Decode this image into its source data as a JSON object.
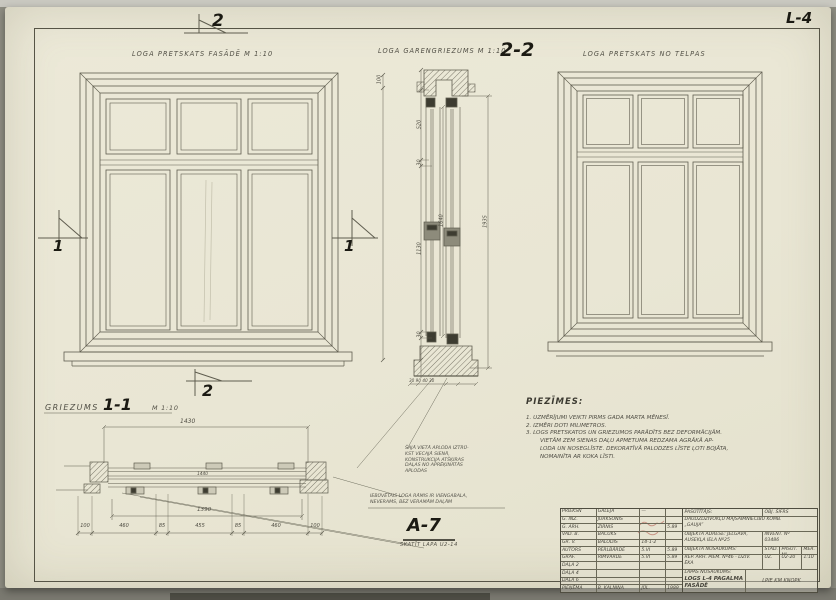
{
  "sheet": {
    "number": "L-4",
    "marks": {
      "top": "2",
      "bottom": "2",
      "left": "1",
      "right": "1"
    }
  },
  "headings": {
    "facade": "LOGA PRETSKATS FASĀDĒ M 1:10",
    "section_title": "LOGA GARENGRIEZUMS M 1:10",
    "section_mark": "2-2",
    "interior": "LOGA PRETSKATS NO TELPAS"
  },
  "vsection": {
    "d100": "100",
    "d520": "520",
    "d30a": "30",
    "d1130": "1130",
    "d30b": "30",
    "overall": "1935",
    "inner": "1640",
    "bottom": "30 90 40 30"
  },
  "hsection": {
    "label": "GRIEZUMS",
    "mark": "1-1",
    "scale": "M 1:10",
    "dim_overall": "1430",
    "dim_inner": "1440",
    "dim_mid": "1390",
    "chain": [
      "100",
      "460",
      "85",
      "455",
      "85",
      "460",
      "100"
    ],
    "detail_mark": "A-7",
    "detail_ref": "SKATĪT LAPA U2-14"
  },
  "annotations": {
    "note_a": [
      "ŠAJĀ VIETĀ APLODA IZTRŪ-",
      "KST VECAJĀ SIENĀ,",
      "KONSTRUKCIJA ATŠĶIRAS",
      "DAĻAS NO APRĒĶINĀTĀS",
      "APLODAS"
    ],
    "note_b": [
      "IEBŪVĒTAIS LOGA RĀMIS IR VIENGABALA,",
      "NEVERAMS, BEZ VERAMĀM DAĻĀM"
    ]
  },
  "notes": {
    "title": "PIEZĪMES:",
    "lines": [
      "1. UZMĒRĪJUMI VEIKTI PIRMS GADA MARTA MĒNESĪ.",
      "2. IZMĒRI DOTI MILIMETROS.",
      "3. LOGS PRETSKATOS UN GRIEZUMOS PARĀDĪTS BEZ DEFORMĀCIJĀM.",
      "VIETĀM ZEM SIENAS DAĻU APMETUMA REDZAMA AGRĀKĀ AP-",
      "LODA UN NOSEGLĪSTE. DEKORATĪVĀ PALODZES LĪSTE ĻOTI BOJĀTA,",
      "NOMAINĪTA AR KOKA LĪSTI."
    ]
  },
  "titleblock": {
    "rows": [
      {
        "role": "PRIEKŠN",
        "name": "GALEJA",
        "sig": "—",
        "date": ""
      },
      {
        "role": "G. INŽ.",
        "name": "JURKSONIS",
        "sig": "",
        "date": ""
      },
      {
        "role": "G. ARH.",
        "name": "ZIRNIS",
        "sig": "",
        "date": "5.89"
      },
      {
        "role": "VAD. B.",
        "name": "BAČUKS",
        "sig": "",
        "date": ""
      },
      {
        "role": "GR. V.",
        "name": "BALODIS",
        "sig": "14-1-2",
        "date": ""
      },
      {
        "role": "AUTORS",
        "name": "PERLBĀRDE",
        "sig": "5.VI",
        "date": "5.89"
      },
      {
        "role": "GRAF.",
        "name": "RIMVĀRDE",
        "sig": "5.VI",
        "date": "5.89"
      },
      {
        "role": "DAĻA 2",
        "name": "",
        "sig": "",
        "date": ""
      },
      {
        "role": "DAĻA 4",
        "name": "",
        "sig": "",
        "date": ""
      },
      {
        "role": "DAĻA 6",
        "name": "",
        "sig": "",
        "date": ""
      },
      {
        "role": "PIEŅĒMA",
        "name": "B. KALNIŅA",
        "sig": "JŪL.",
        "date": "1989"
      }
    ],
    "client_label": "PASŪTĪTĀJS:",
    "obj_cipher": "OBJ. ŠIFRS",
    "client_line1": "DAUDZDZĪVOKĻU MĀJSAIMNIECĪBU KOMB.",
    "client_line2": "„GAUJA”",
    "address_label": "OBJEKTA ADRESE: JELGAVA,",
    "address_line2": "AUSEKĻA IELA Nº25",
    "invent_label": "INVENT. Nº",
    "invent_no": "03486",
    "objname_label": "OBJEKTA NOSAUKUMS:",
    "stage_label": "STAD.",
    "order_label": "PASŪT. Nº",
    "scale_label": "MĒR.",
    "objname_line1": "REP. ARH. PIEM. Nº46 - DZĪV.",
    "objname_line2": "ĒKA",
    "stage_val": "UZ.",
    "order_val": "U2-20",
    "scale_val": "1:10",
    "sheetname_label": "LAPAS NOSAUKUMS:",
    "sheetname_line1": "LOGS L-4 PAGALMA",
    "sheetname_line2": "FASĀDĒ",
    "stamp_text": "LPIE KM KNOPK"
  }
}
